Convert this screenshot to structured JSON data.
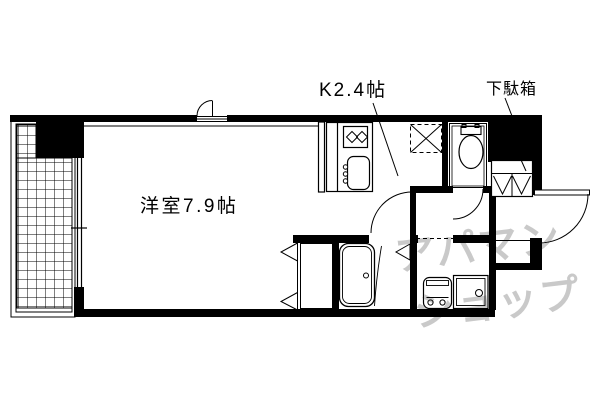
{
  "colors": {
    "line": "#000000",
    "background": "#ffffff",
    "watermark": "#c9c9c9"
  },
  "floorplan": {
    "labels": {
      "main_room": "洋室7.9帖",
      "kitchen": "K2.4帖",
      "shoe_cabinet": "下駄箱"
    },
    "rooms": [
      {
        "name": "洋室",
        "size": "7.9帖"
      },
      {
        "name": "K",
        "size": "2.4帖"
      }
    ],
    "fixture_icons": [
      "balcony-tile-grid",
      "sliding-window",
      "stove-burners",
      "kitchen-sink",
      "refrigerator-space-x-box",
      "toilet",
      "shoe-cabinet-shelves",
      "entrance-door",
      "closet-bifold-door",
      "bathtub",
      "vanity-basin",
      "washing-machine-pan"
    ]
  },
  "watermark": {
    "line1": "アパマン",
    "line2": "ショップ"
  }
}
